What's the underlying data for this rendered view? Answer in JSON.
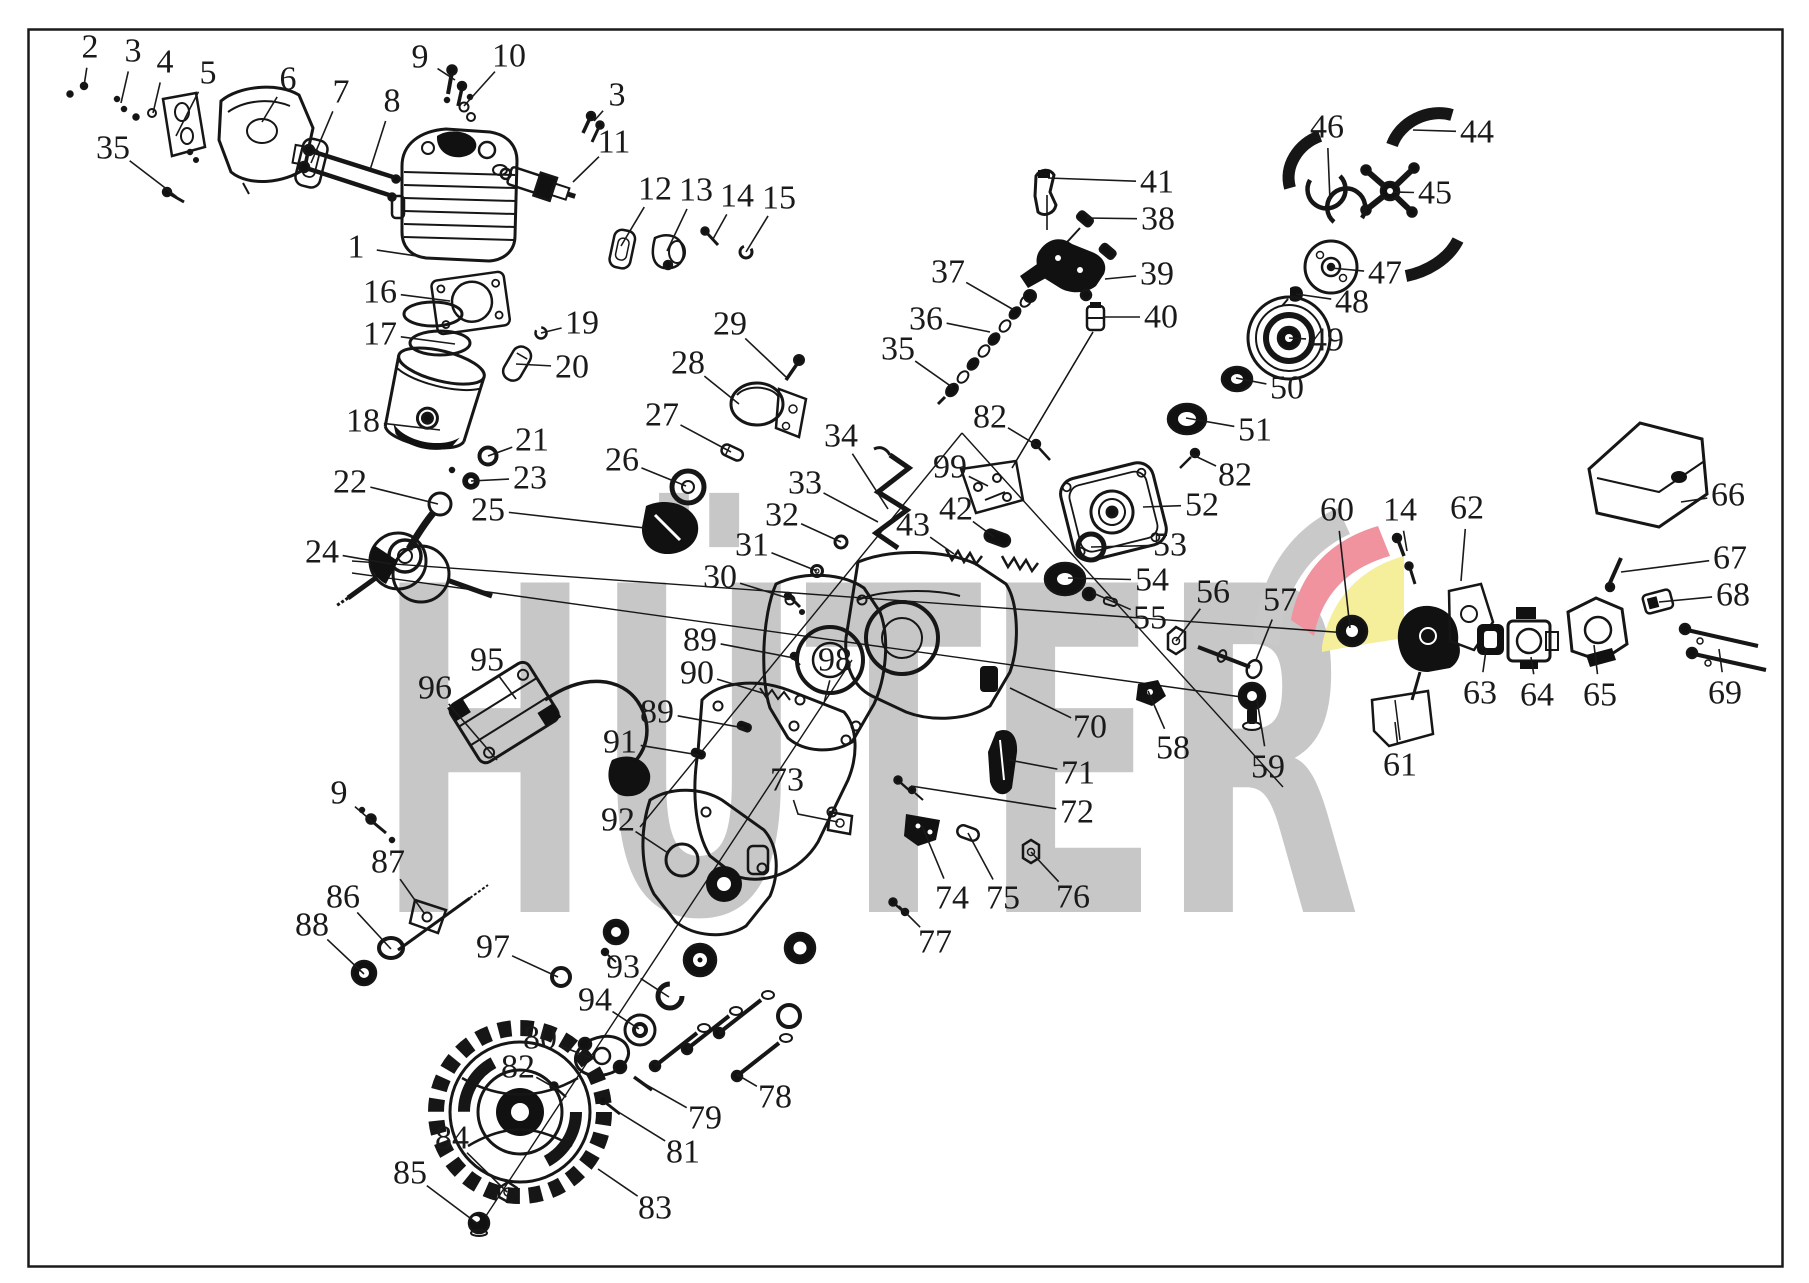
{
  "watermark": {
    "text": "HÜTER",
    "color": "#c7c7c7"
  },
  "logo": {
    "gray": "#c9c9c9",
    "red": "#f0939e",
    "yellow": "#f5ee9b"
  },
  "diagram": {
    "line_color": "#1a1a1a",
    "label_font_size": 34
  },
  "callouts": [
    {
      "n": "2",
      "x": 90,
      "y": 47,
      "tx": 84,
      "ty": 86
    },
    {
      "n": "3",
      "x": 133,
      "y": 51,
      "tx": 121,
      "ty": 103
    },
    {
      "n": "4",
      "x": 165,
      "y": 62,
      "tx": 153,
      "ty": 113
    },
    {
      "n": "5",
      "x": 208,
      "y": 73,
      "tx": 176,
      "ty": 136
    },
    {
      "n": "6",
      "x": 288,
      "y": 79,
      "tx": 262,
      "ty": 122
    },
    {
      "n": "7",
      "x": 341,
      "y": 92,
      "tx": 311,
      "ty": 163
    },
    {
      "n": "8",
      "x": 392,
      "y": 101,
      "tx": 370,
      "ty": 170
    },
    {
      "n": "35",
      "x": 113,
      "y": 148,
      "tx": 177,
      "ty": 197
    },
    {
      "n": "9",
      "x": 420,
      "y": 57,
      "tx": 455,
      "ty": 80
    },
    {
      "n": "10",
      "x": 509,
      "y": 56,
      "tx": 464,
      "ty": 106
    },
    {
      "n": "3",
      "x": 617,
      "y": 95,
      "tx": 594,
      "ty": 121
    },
    {
      "n": "11",
      "x": 614,
      "y": 142,
      "tx": 573,
      "ty": 182
    },
    {
      "n": "1",
      "x": 356,
      "y": 247,
      "tx": 437,
      "ty": 259
    },
    {
      "n": "12",
      "x": 655,
      "y": 189,
      "tx": 621,
      "ty": 246
    },
    {
      "n": "13",
      "x": 696,
      "y": 190,
      "tx": 667,
      "ty": 251
    },
    {
      "n": "14",
      "x": 737,
      "y": 196,
      "tx": 713,
      "ty": 239
    },
    {
      "n": "15",
      "x": 779,
      "y": 198,
      "tx": 746,
      "ty": 252
    },
    {
      "n": "16",
      "x": 380,
      "y": 292,
      "tx": 450,
      "ty": 301
    },
    {
      "n": "17",
      "x": 380,
      "y": 334,
      "tx": 455,
      "ty": 344
    },
    {
      "n": "19",
      "x": 582,
      "y": 323,
      "tx": 541,
      "ty": 333
    },
    {
      "n": "20",
      "x": 572,
      "y": 367,
      "tx": 516,
      "ty": 364
    },
    {
      "n": "18",
      "x": 363,
      "y": 421,
      "tx": 440,
      "ty": 430
    },
    {
      "n": "21",
      "x": 532,
      "y": 440,
      "tx": 488,
      "ty": 456
    },
    {
      "n": "23",
      "x": 530,
      "y": 478,
      "tx": 471,
      "ty": 481
    },
    {
      "n": "22",
      "x": 350,
      "y": 482,
      "tx": 438,
      "ty": 504
    },
    {
      "n": "24",
      "x": 322,
      "y": 552,
      "tx": 391,
      "ty": 564
    },
    {
      "n": "25",
      "x": 488,
      "y": 510,
      "tx": 645,
      "ty": 528
    },
    {
      "n": "26",
      "x": 622,
      "y": 460,
      "tx": 686,
      "ty": 486
    },
    {
      "n": "27",
      "x": 662,
      "y": 415,
      "tx": 731,
      "ty": 452
    },
    {
      "n": "28",
      "x": 688,
      "y": 363,
      "tx": 739,
      "ty": 404
    },
    {
      "n": "29",
      "x": 730,
      "y": 324,
      "tx": 786,
      "ty": 377
    },
    {
      "n": "30",
      "x": 720,
      "y": 577,
      "tx": 794,
      "ty": 600
    },
    {
      "n": "31",
      "x": 752,
      "y": 545,
      "tx": 817,
      "ty": 571
    },
    {
      "n": "32",
      "x": 782,
      "y": 515,
      "tx": 841,
      "ty": 542
    },
    {
      "n": "33",
      "x": 805,
      "y": 483,
      "tx": 878,
      "ty": 522
    },
    {
      "n": "34",
      "x": 841,
      "y": 436,
      "tx": 888,
      "ty": 509
    },
    {
      "n": "35",
      "x": 898,
      "y": 349,
      "tx": 952,
      "ty": 387
    },
    {
      "n": "36",
      "x": 926,
      "y": 319,
      "tx": 990,
      "ty": 332
    },
    {
      "n": "37",
      "x": 948,
      "y": 272,
      "tx": 1014,
      "ty": 310
    },
    {
      "n": "38",
      "x": 1158,
      "y": 219,
      "tx": 1086,
      "ty": 218
    },
    {
      "n": "39",
      "x": 1157,
      "y": 274,
      "tx": 1105,
      "ty": 279
    },
    {
      "n": "40",
      "x": 1161,
      "y": 317,
      "tx": 1104,
      "ty": 317
    },
    {
      "n": "41",
      "x": 1157,
      "y": 182,
      "tx": 1048,
      "ty": 178
    },
    {
      "n": "42",
      "x": 956,
      "y": 509,
      "tx": 994,
      "ty": 537
    },
    {
      "n": "43",
      "x": 913,
      "y": 525,
      "tx": 954,
      "ty": 554
    },
    {
      "n": "44",
      "x": 1477,
      "y": 132,
      "tx": 1413,
      "ty": 130
    },
    {
      "n": "45",
      "x": 1435,
      "y": 193,
      "tx": 1393,
      "ty": 192
    },
    {
      "n": "46",
      "x": 1327,
      "y": 127,
      "tx": 1330,
      "ty": 201
    },
    {
      "n": "47",
      "x": 1385,
      "y": 273,
      "tx": 1331,
      "ty": 268
    },
    {
      "n": "48",
      "x": 1352,
      "y": 302,
      "tx": 1296,
      "ty": 294
    },
    {
      "n": "49",
      "x": 1327,
      "y": 340,
      "tx": 1289,
      "ty": 338
    },
    {
      "n": "50",
      "x": 1287,
      "y": 388,
      "tx": 1236,
      "ty": 378
    },
    {
      "n": "51",
      "x": 1255,
      "y": 430,
      "tx": 1186,
      "ty": 418
    },
    {
      "n": "52",
      "x": 1202,
      "y": 505,
      "tx": 1143,
      "ty": 507
    },
    {
      "n": "53",
      "x": 1170,
      "y": 545,
      "tx": 1091,
      "ty": 547
    },
    {
      "n": "54",
      "x": 1152,
      "y": 580,
      "tx": 1068,
      "ty": 578
    },
    {
      "n": "55",
      "x": 1150,
      "y": 618,
      "tx": 1093,
      "ty": 593
    },
    {
      "n": "56",
      "x": 1213,
      "y": 592,
      "tx": 1176,
      "ty": 641
    },
    {
      "n": "57",
      "x": 1280,
      "y": 600,
      "tx": 1256,
      "ty": 660
    },
    {
      "n": "58",
      "x": 1173,
      "y": 748,
      "tx": 1148,
      "ty": 691
    },
    {
      "n": "59",
      "x": 1268,
      "y": 767,
      "tx": 1257,
      "ty": 700
    },
    {
      "n": "60",
      "x": 1337,
      "y": 510,
      "tx": 1350,
      "ty": 628
    },
    {
      "n": "14",
      "x": 1400,
      "y": 510,
      "tx": 1407,
      "ty": 551
    },
    {
      "n": "62",
      "x": 1467,
      "y": 508,
      "tx": 1461,
      "ty": 581
    },
    {
      "n": "61",
      "x": 1400,
      "y": 765,
      "tx": 1395,
      "ty": 722
    },
    {
      "n": "63",
      "x": 1480,
      "y": 693,
      "tx": 1486,
      "ty": 650
    },
    {
      "n": "64",
      "x": 1537,
      "y": 695,
      "tx": 1531,
      "ty": 657
    },
    {
      "n": "65",
      "x": 1600,
      "y": 695,
      "tx": 1594,
      "ty": 645
    },
    {
      "n": "66",
      "x": 1728,
      "y": 495,
      "tx": 1681,
      "ty": 502
    },
    {
      "n": "67",
      "x": 1730,
      "y": 558,
      "tx": 1621,
      "ty": 572
    },
    {
      "n": "68",
      "x": 1733,
      "y": 595,
      "tx": 1659,
      "ty": 602
    },
    {
      "n": "69",
      "x": 1725,
      "y": 693,
      "tx": 1719,
      "ty": 649
    },
    {
      "n": "70",
      "x": 1090,
      "y": 727,
      "tx": 1010,
      "ty": 688
    },
    {
      "n": "71",
      "x": 1078,
      "y": 773,
      "tx": 1009,
      "ty": 760
    },
    {
      "n": "72",
      "x": 1077,
      "y": 812,
      "tx": 911,
      "ty": 786
    },
    {
      "n": "73",
      "x": 787,
      "y": 780,
      "tx": 838,
      "ty": 822,
      "via": [
        798,
        814
      ]
    },
    {
      "n": "74",
      "x": 952,
      "y": 898,
      "tx": 922,
      "ty": 826
    },
    {
      "n": "75",
      "x": 1003,
      "y": 898,
      "tx": 968,
      "ty": 833
    },
    {
      "n": "76",
      "x": 1073,
      "y": 897,
      "tx": 1031,
      "ty": 852
    },
    {
      "n": "77",
      "x": 935,
      "y": 942,
      "tx": 899,
      "ty": 906
    },
    {
      "n": "78",
      "x": 775,
      "y": 1097,
      "tx": 736,
      "ty": 1074
    },
    {
      "n": "79",
      "x": 705,
      "y": 1118,
      "tx": 643,
      "ty": 1083
    },
    {
      "n": "80",
      "x": 540,
      "y": 1038,
      "tx": 594,
      "ty": 1059
    },
    {
      "n": "81",
      "x": 683,
      "y": 1152,
      "tx": 620,
      "ty": 1113
    },
    {
      "n": "82",
      "x": 990,
      "y": 417,
      "tx": 1038,
      "ty": 446
    },
    {
      "n": "82",
      "x": 1235,
      "y": 475,
      "tx": 1193,
      "ty": 455
    },
    {
      "n": "82",
      "x": 518,
      "y": 1067,
      "tx": 557,
      "ty": 1089
    },
    {
      "n": "83",
      "x": 655,
      "y": 1208,
      "tx": 598,
      "ty": 1169
    },
    {
      "n": "84",
      "x": 452,
      "y": 1138,
      "tx": 507,
      "ty": 1192
    },
    {
      "n": "85",
      "x": 410,
      "y": 1173,
      "tx": 478,
      "ty": 1224
    },
    {
      "n": "86",
      "x": 343,
      "y": 897,
      "tx": 391,
      "ty": 949
    },
    {
      "n": "87",
      "x": 388,
      "y": 862,
      "tx": 424,
      "ty": 913
    },
    {
      "n": "88",
      "x": 312,
      "y": 925,
      "tx": 364,
      "ty": 974
    },
    {
      "n": "89",
      "x": 700,
      "y": 640,
      "tx": 794,
      "ty": 658
    },
    {
      "n": "90",
      "x": 697,
      "y": 673,
      "tx": 769,
      "ty": 695
    },
    {
      "n": "89",
      "x": 657,
      "y": 712,
      "tx": 744,
      "ty": 728
    },
    {
      "n": "91",
      "x": 620,
      "y": 742,
      "tx": 699,
      "ty": 755
    },
    {
      "n": "92",
      "x": 618,
      "y": 820,
      "tx": 668,
      "ty": 853
    },
    {
      "n": "93",
      "x": 623,
      "y": 967,
      "tx": 669,
      "ty": 997
    },
    {
      "n": "94",
      "x": 595,
      "y": 1000,
      "tx": 639,
      "ty": 1029
    },
    {
      "n": "95",
      "x": 487,
      "y": 660,
      "tx": 516,
      "ty": 699
    },
    {
      "n": "96",
      "x": 435,
      "y": 688,
      "tx": 497,
      "ty": 760
    },
    {
      "n": "97",
      "x": 493,
      "y": 947,
      "tx": 558,
      "ty": 977
    },
    {
      "n": "98",
      "x": 835,
      "y": 660,
      "tx": 824,
      "ty": 703
    },
    {
      "n": "99",
      "x": 950,
      "y": 467,
      "tx": 988,
      "ty": 486
    },
    {
      "n": "9",
      "x": 339,
      "y": 793,
      "tx": 374,
      "ty": 823
    }
  ]
}
